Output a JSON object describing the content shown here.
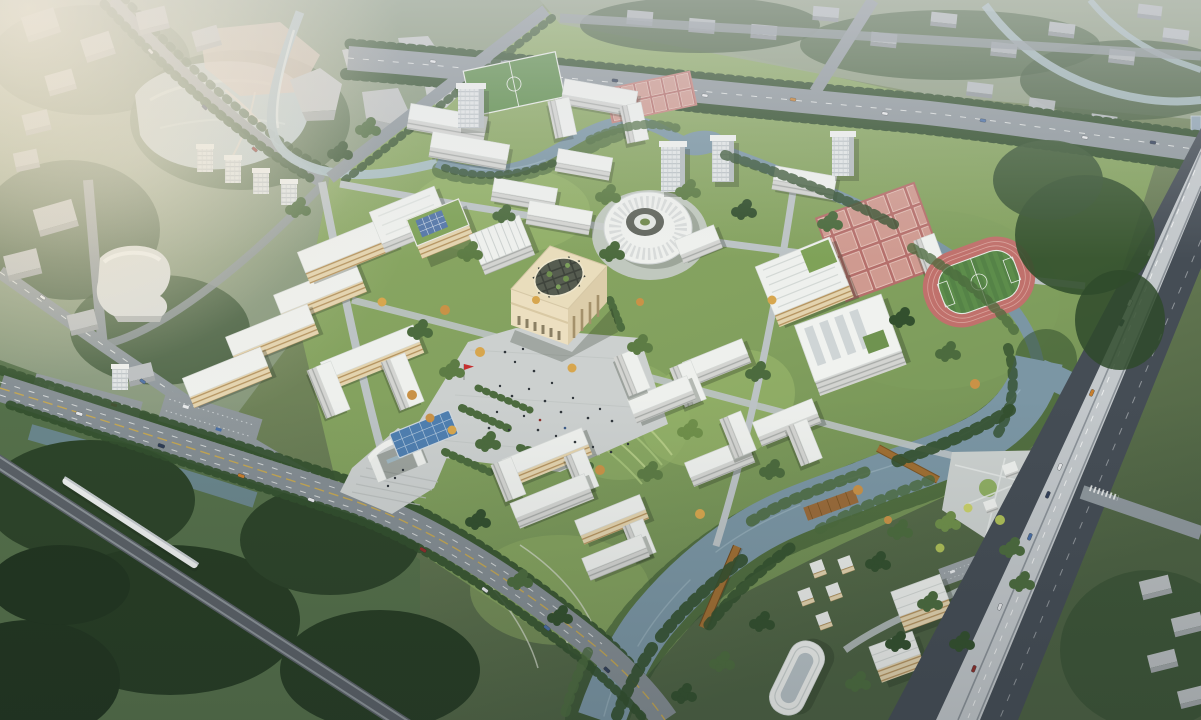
{
  "image": {
    "kind": "aerial architectural rendering",
    "subject": "university campus master plan, bird's-eye perspective view",
    "lighting": "hazy warm sunlight from upper left, dimmer toward bottom"
  },
  "palette": {
    "ground": "#74875c",
    "ground_dark": "#4c6142",
    "campus_green": "#82a05e",
    "lawn": "#9cb96d",
    "forest": "#33502e",
    "tree": "#4c6b3e",
    "tree_light": "#6f8f4a",
    "tree_autumn": "#c99247",
    "water_river": "#7b96a4",
    "water_lake": "#b9c9cb",
    "water_canal": "#a9bec5",
    "water_pool": "#4f7fb0",
    "road_major": "#8e979c",
    "road_front": "#848d92",
    "road_campus": "#bcc3c5",
    "road_dark": "#454d55",
    "viaduct": "#c3c8cb",
    "rail": "#6a7076",
    "train": "#eff1f0",
    "building_white": "#eef0ed",
    "building_face": "#d3d4d1",
    "building_warm": "#e3d3ae",
    "building_cream": "#e9ddbc",
    "building_cream_shade": "#dccdaa",
    "city_block": "#babec0",
    "city_tower": "#dfe3e4",
    "roof_green": "#7fa258",
    "solar_blue": "#5577a8",
    "track_red": "#c0716c",
    "court_red": "#b56f6b",
    "court_cell": "#cf9a90",
    "field_green": "#5d8d4b",
    "bridge_wood": "#a06f33",
    "bridge_orange": "#c27b3c",
    "flag_red": "#c53030",
    "plaza": "#ccd0cf",
    "shadow": "#1f2c1c",
    "haze_warm": "#f5e7c9"
  },
  "features": {
    "campus": [
      "main cube building with circular roof pergola",
      "round ribbed concert-hall dome",
      "central plaza with crowds and red flag",
      "entrance gate with steps",
      "blue reflecting pool with grid",
      "green-roof building with solar panels",
      "ribbed-roof lecture hall",
      "west academic slab cluster",
      "U-shaped courtyard buildings",
      "four L-shaped academic buildings around lawn",
      "dormitory slabs and towers",
      "canteen with part-green roof",
      "gymnasium with skylight roof",
      "running track with soccer infield",
      "basketball court grids (large and small)",
      "north soccer field",
      "terraced riverside lawns",
      "winding campus stream with pond"
    ],
    "water": [
      "wide river along south-east edge",
      "campus stream",
      "city lake (north-west)",
      "canal corridors",
      "orange footbridge",
      "two wooden footbridges",
      "timber riverside deck"
    ],
    "infrastructure": [
      "east-west arterial road with street trees",
      "front road with yellow center line",
      "diagonal railway with white high-speed train",
      "elevated expressway viaduct with traffic",
      "surface parking lots",
      "riverside plaza with circular lawn"
    ],
    "context": [
      "hazy north-west city blocks and lake park",
      "curved cultural building",
      "rows of grey residential slabs (north and north-east)",
      "south-east faculty apartments, small villas and curved hotel block",
      "dense dark forest in south-west corner",
      "glass tower sliver at right edge"
    ]
  }
}
